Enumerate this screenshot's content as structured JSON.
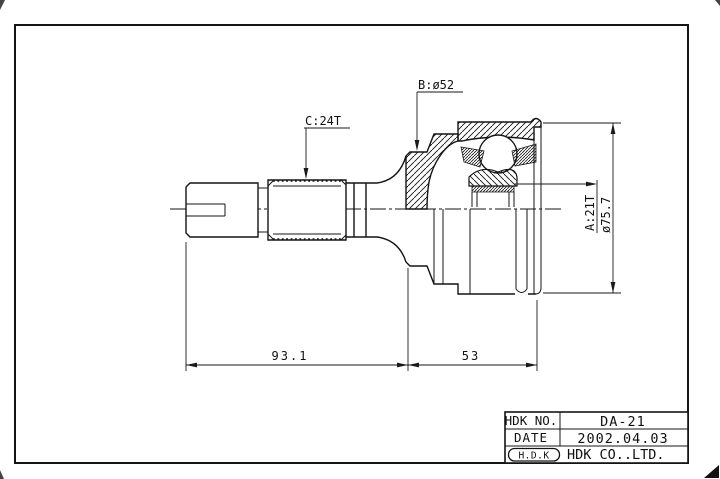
{
  "page": {
    "background": "#ffffff",
    "line_color": "#141414"
  },
  "annotations": {
    "outer_race_boot_dia": "B:ø52",
    "shaft_spline": "C:24T",
    "inner_race_spline": "A:21T",
    "outer_dia": "ø75.7",
    "shaft_length": "93.1",
    "joint_length": "53"
  },
  "title_block": {
    "rows": [
      {
        "label": "HDK NO.",
        "value": "DA-21"
      },
      {
        "label": "DATE",
        "value": "2002.04.03"
      },
      {
        "label": "H.D.K",
        "value": "HDK CO..LTD."
      }
    ]
  }
}
